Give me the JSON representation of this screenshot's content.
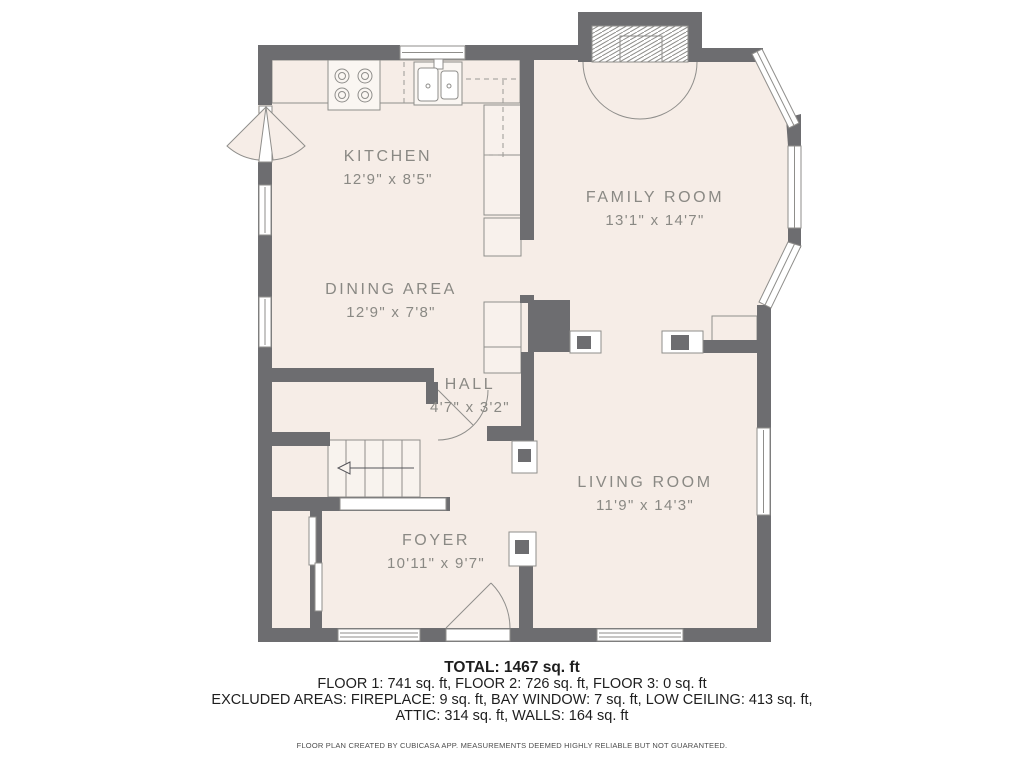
{
  "plan": {
    "rooms": {
      "kitchen": {
        "name": "KITCHEN",
        "dims": "12'9\" x 8'5\""
      },
      "family_room": {
        "name": "FAMILY ROOM",
        "dims": "13'1\" x 14'7\""
      },
      "dining_area": {
        "name": "DINING AREA",
        "dims": "12'9\" x 7'8\""
      },
      "hall": {
        "name": "HALL",
        "dims": "4'7\" x 3'2\""
      },
      "living_room": {
        "name": "LIVING ROOM",
        "dims": "11'9\" x 14'3\""
      },
      "foyer": {
        "name": "FOYER",
        "dims": "10'11\" x 9'7\""
      }
    },
    "summary": {
      "total": "TOTAL: 1467 sq. ft",
      "floors": "FLOOR 1: 741 sq. ft, FLOOR 2: 726 sq. ft, FLOOR 3: 0 sq. ft",
      "excluded_line1": "EXCLUDED AREAS: FIREPLACE: 9 sq. ft, BAY WINDOW: 7 sq. ft, LOW CEILING: 413 sq. ft,",
      "excluded_line2": "ATTIC: 314 sq. ft, WALLS: 164 sq. ft",
      "disclaimer": "FLOOR PLAN CREATED BY CUBICASA APP. MEASUREMENTS DEEMED HIGHLY RELIABLE BUT NOT GUARANTEED."
    },
    "colors": {
      "floor": "#f6ede7",
      "wall": "#6d6d70",
      "outline": "#8f8e8b",
      "label_text": "#8a8984",
      "summary_text": "#1e1e1e"
    }
  }
}
